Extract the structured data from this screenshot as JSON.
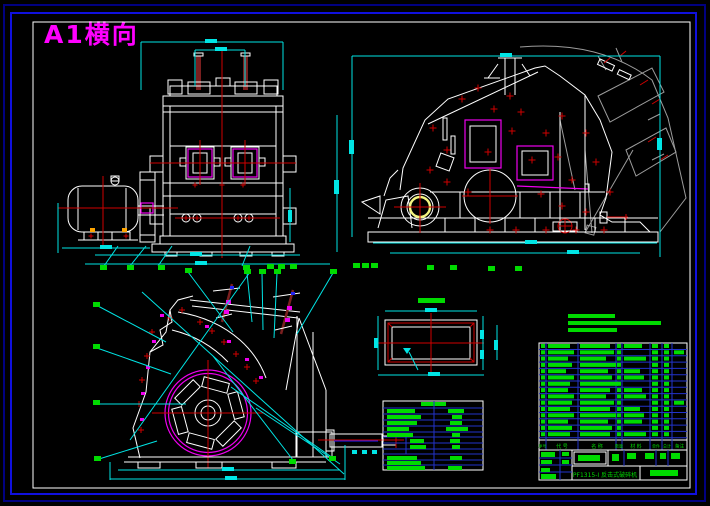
{
  "page": {
    "sheet_label": "A1横向",
    "background": "#000000",
    "colors": {
      "frame_navy": "#000080",
      "frame_blue": "#1010DD",
      "frame_white": "#FFFFFF",
      "linework_white": "#FFFFFF",
      "dimension_cyan": "#00E5E5",
      "centerline_red": "#CF0000",
      "detail_magenta": "#EE00EE",
      "ghost_gray": "#9C9C9C",
      "table_text_green": "#00DB00",
      "table_grid_blue": "#2233CC",
      "bearing_yellow": "#F5F580",
      "bolt_dark_red": "#7A1F1F",
      "label_magenta": "#FF00FF"
    }
  },
  "views": {
    "front": {
      "name": "front elevation with drive motor"
    },
    "side": {
      "name": "side elevation with opened housing (ghost lines)"
    },
    "section": {
      "name": "cross section through rotor"
    },
    "plate": {
      "name": "plate detail top view"
    }
  },
  "bom": {
    "headers": [
      "序号",
      "代 号",
      "名 称",
      "数量",
      "材 料",
      "单件",
      "总计",
      "备注"
    ]
  },
  "title_block": {
    "drawing_title": "PF1315-Ⅰ 反击式破碎机"
  }
}
